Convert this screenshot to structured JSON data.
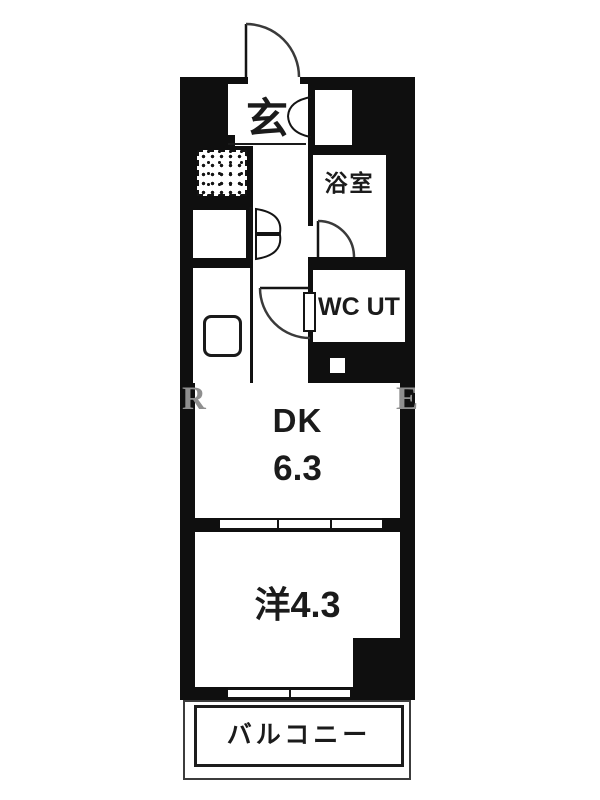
{
  "plan": {
    "rooms": {
      "genkan": {
        "label": "玄"
      },
      "bathroom": {
        "label": "浴室"
      },
      "wc_ut": {
        "label": "WC UT"
      },
      "dk": {
        "name": "DK",
        "size": "6.3"
      },
      "western_room": {
        "label": "洋4.3"
      },
      "balcony": {
        "label": "バルコニー"
      }
    },
    "watermark": {
      "left_letter": "R",
      "right_letter": "E"
    },
    "colors": {
      "wall": "#0f0f0f",
      "floor": "#ffffff",
      "line": "#141414",
      "watermark": "#8f8f8f"
    },
    "symbols": [
      "entry-door-swing-arc",
      "shoe-cabinet-double-arc",
      "bifold-closet-door",
      "wc-door-swing-arc",
      "bathroom-door-swing-arc",
      "sliding-partition",
      "sliding-window",
      "kitchen-sink",
      "hatched-utility-area"
    ]
  }
}
